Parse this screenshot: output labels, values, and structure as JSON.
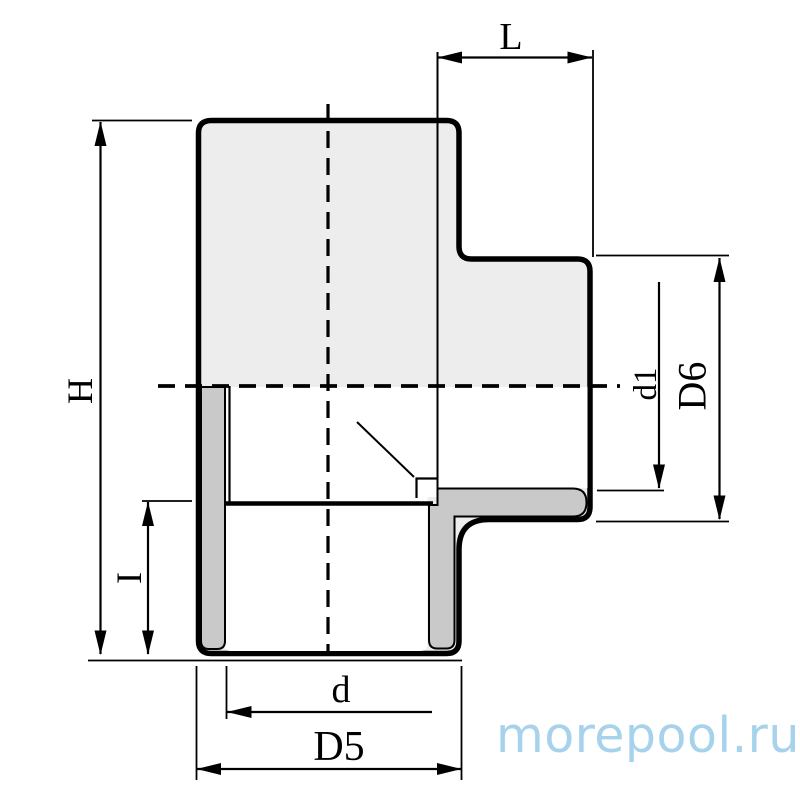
{
  "drawing": {
    "kind": "technical-section-drawing",
    "subject": "tee-fitting-cross-section",
    "dimensions": {
      "L": "L",
      "H": "H",
      "I": "I",
      "d": "d",
      "D5": "D5",
      "d1": "d1",
      "D6": "D6"
    }
  },
  "watermark": {
    "text": "morepool.ru",
    "color": "#a7d2ec"
  },
  "colors": {
    "outline": "#000000",
    "body_fill": "#ededed",
    "section_wall_fill": "#c9c9c9",
    "background": "#ffffff"
  }
}
